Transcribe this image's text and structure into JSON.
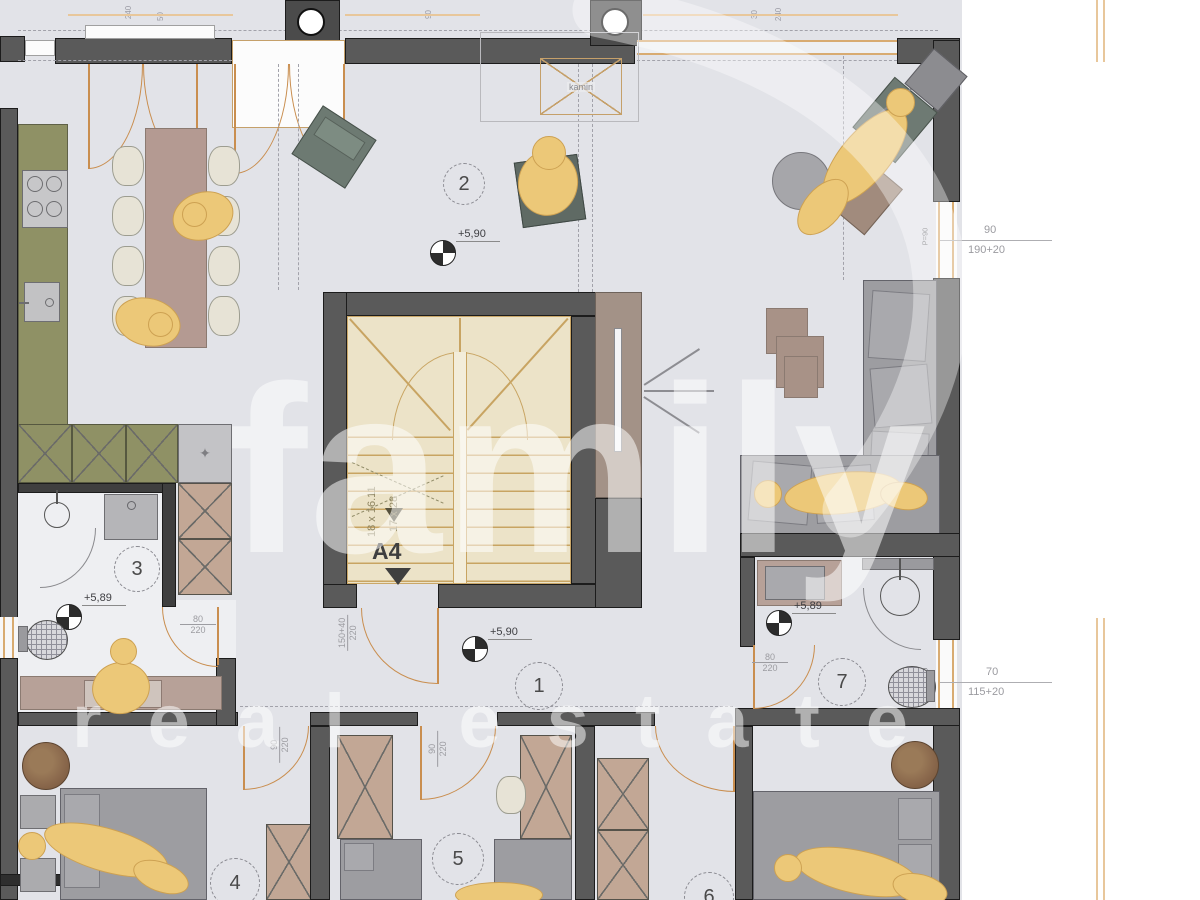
{
  "watermark": {
    "line1": "family",
    "line2": "real estate"
  },
  "rooms": {
    "n1": "1",
    "n2": "2",
    "n3": "3",
    "n4": "4",
    "n5": "5",
    "n6": "6",
    "n7": "7"
  },
  "levels": {
    "upper": "+5,90",
    "lower": "+5,89"
  },
  "stairs": {
    "flight_a": "18 x 16.11",
    "flight_b": "17 x 28",
    "section": "A4"
  },
  "fireplace": {
    "label": "kamin"
  },
  "doors": {
    "w80": "80",
    "w90": "90",
    "w150": "150+40",
    "h": "220"
  },
  "dimensions": {
    "right_top": {
      "num": "90",
      "den": "190+20"
    },
    "right_bottom": {
      "num": "70",
      "den": "115+20"
    },
    "parapet": "P=90",
    "top_edge": [
      "240",
      "50",
      "90",
      "30",
      "240"
    ]
  },
  "symbols": {
    "plant": "✦"
  },
  "colors": {
    "floor": "#e2e3e8",
    "wall": "#5a5a5a",
    "stair": "#ece3c8",
    "accent_door": "#c98e4f",
    "furniture_wood": "#b7a198",
    "kitchen": "#8f9165",
    "person": "#ecc878",
    "sofa": "#9d9da1",
    "pouf": "#8a684c"
  }
}
